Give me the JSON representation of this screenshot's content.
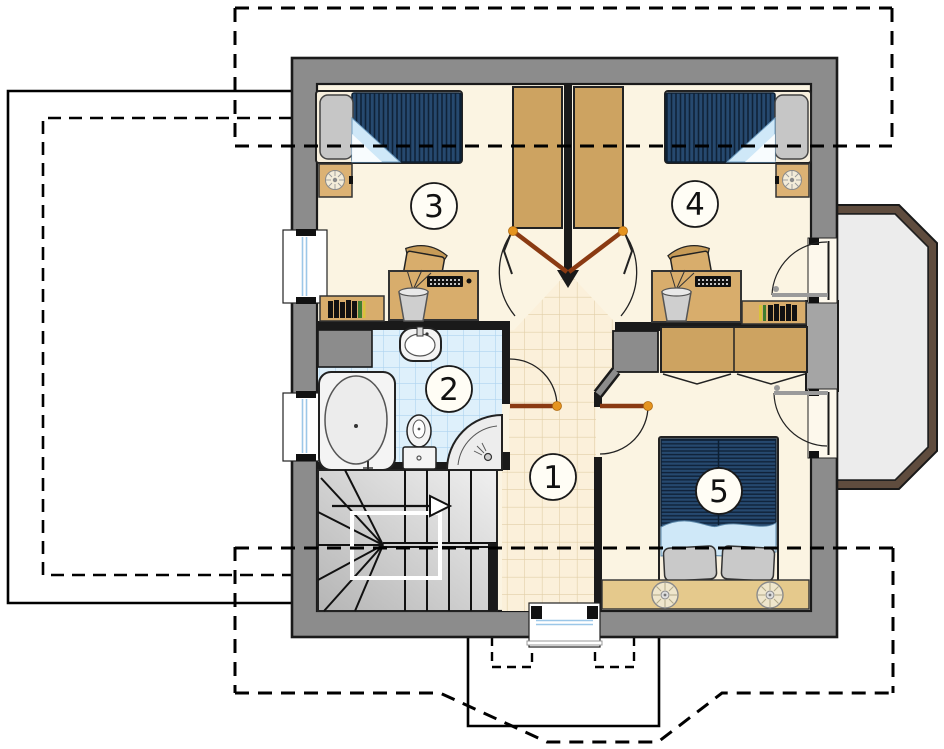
{
  "plan": {
    "rooms": [
      {
        "number": "1"
      },
      {
        "number": "2"
      },
      {
        "number": "3"
      },
      {
        "number": "4"
      },
      {
        "number": "5"
      }
    ],
    "colors": {
      "wall_gray": "#8c8c8c",
      "floor_cream": "#fbf4e2",
      "hall_tile": "#fbf0da",
      "bath_tile": "#def0fb",
      "furniture_tan": "#d8ad6c",
      "wardrobe_tan": "#cda361",
      "bed_navy": "#26496f",
      "blanket_blue": "#cfe8f8",
      "door_brown": "#8a3a12",
      "handle_orange": "#e5941f",
      "balcony_wall_brown": "#5f4c3e",
      "balcony_floor_gray": "#ececec"
    }
  }
}
